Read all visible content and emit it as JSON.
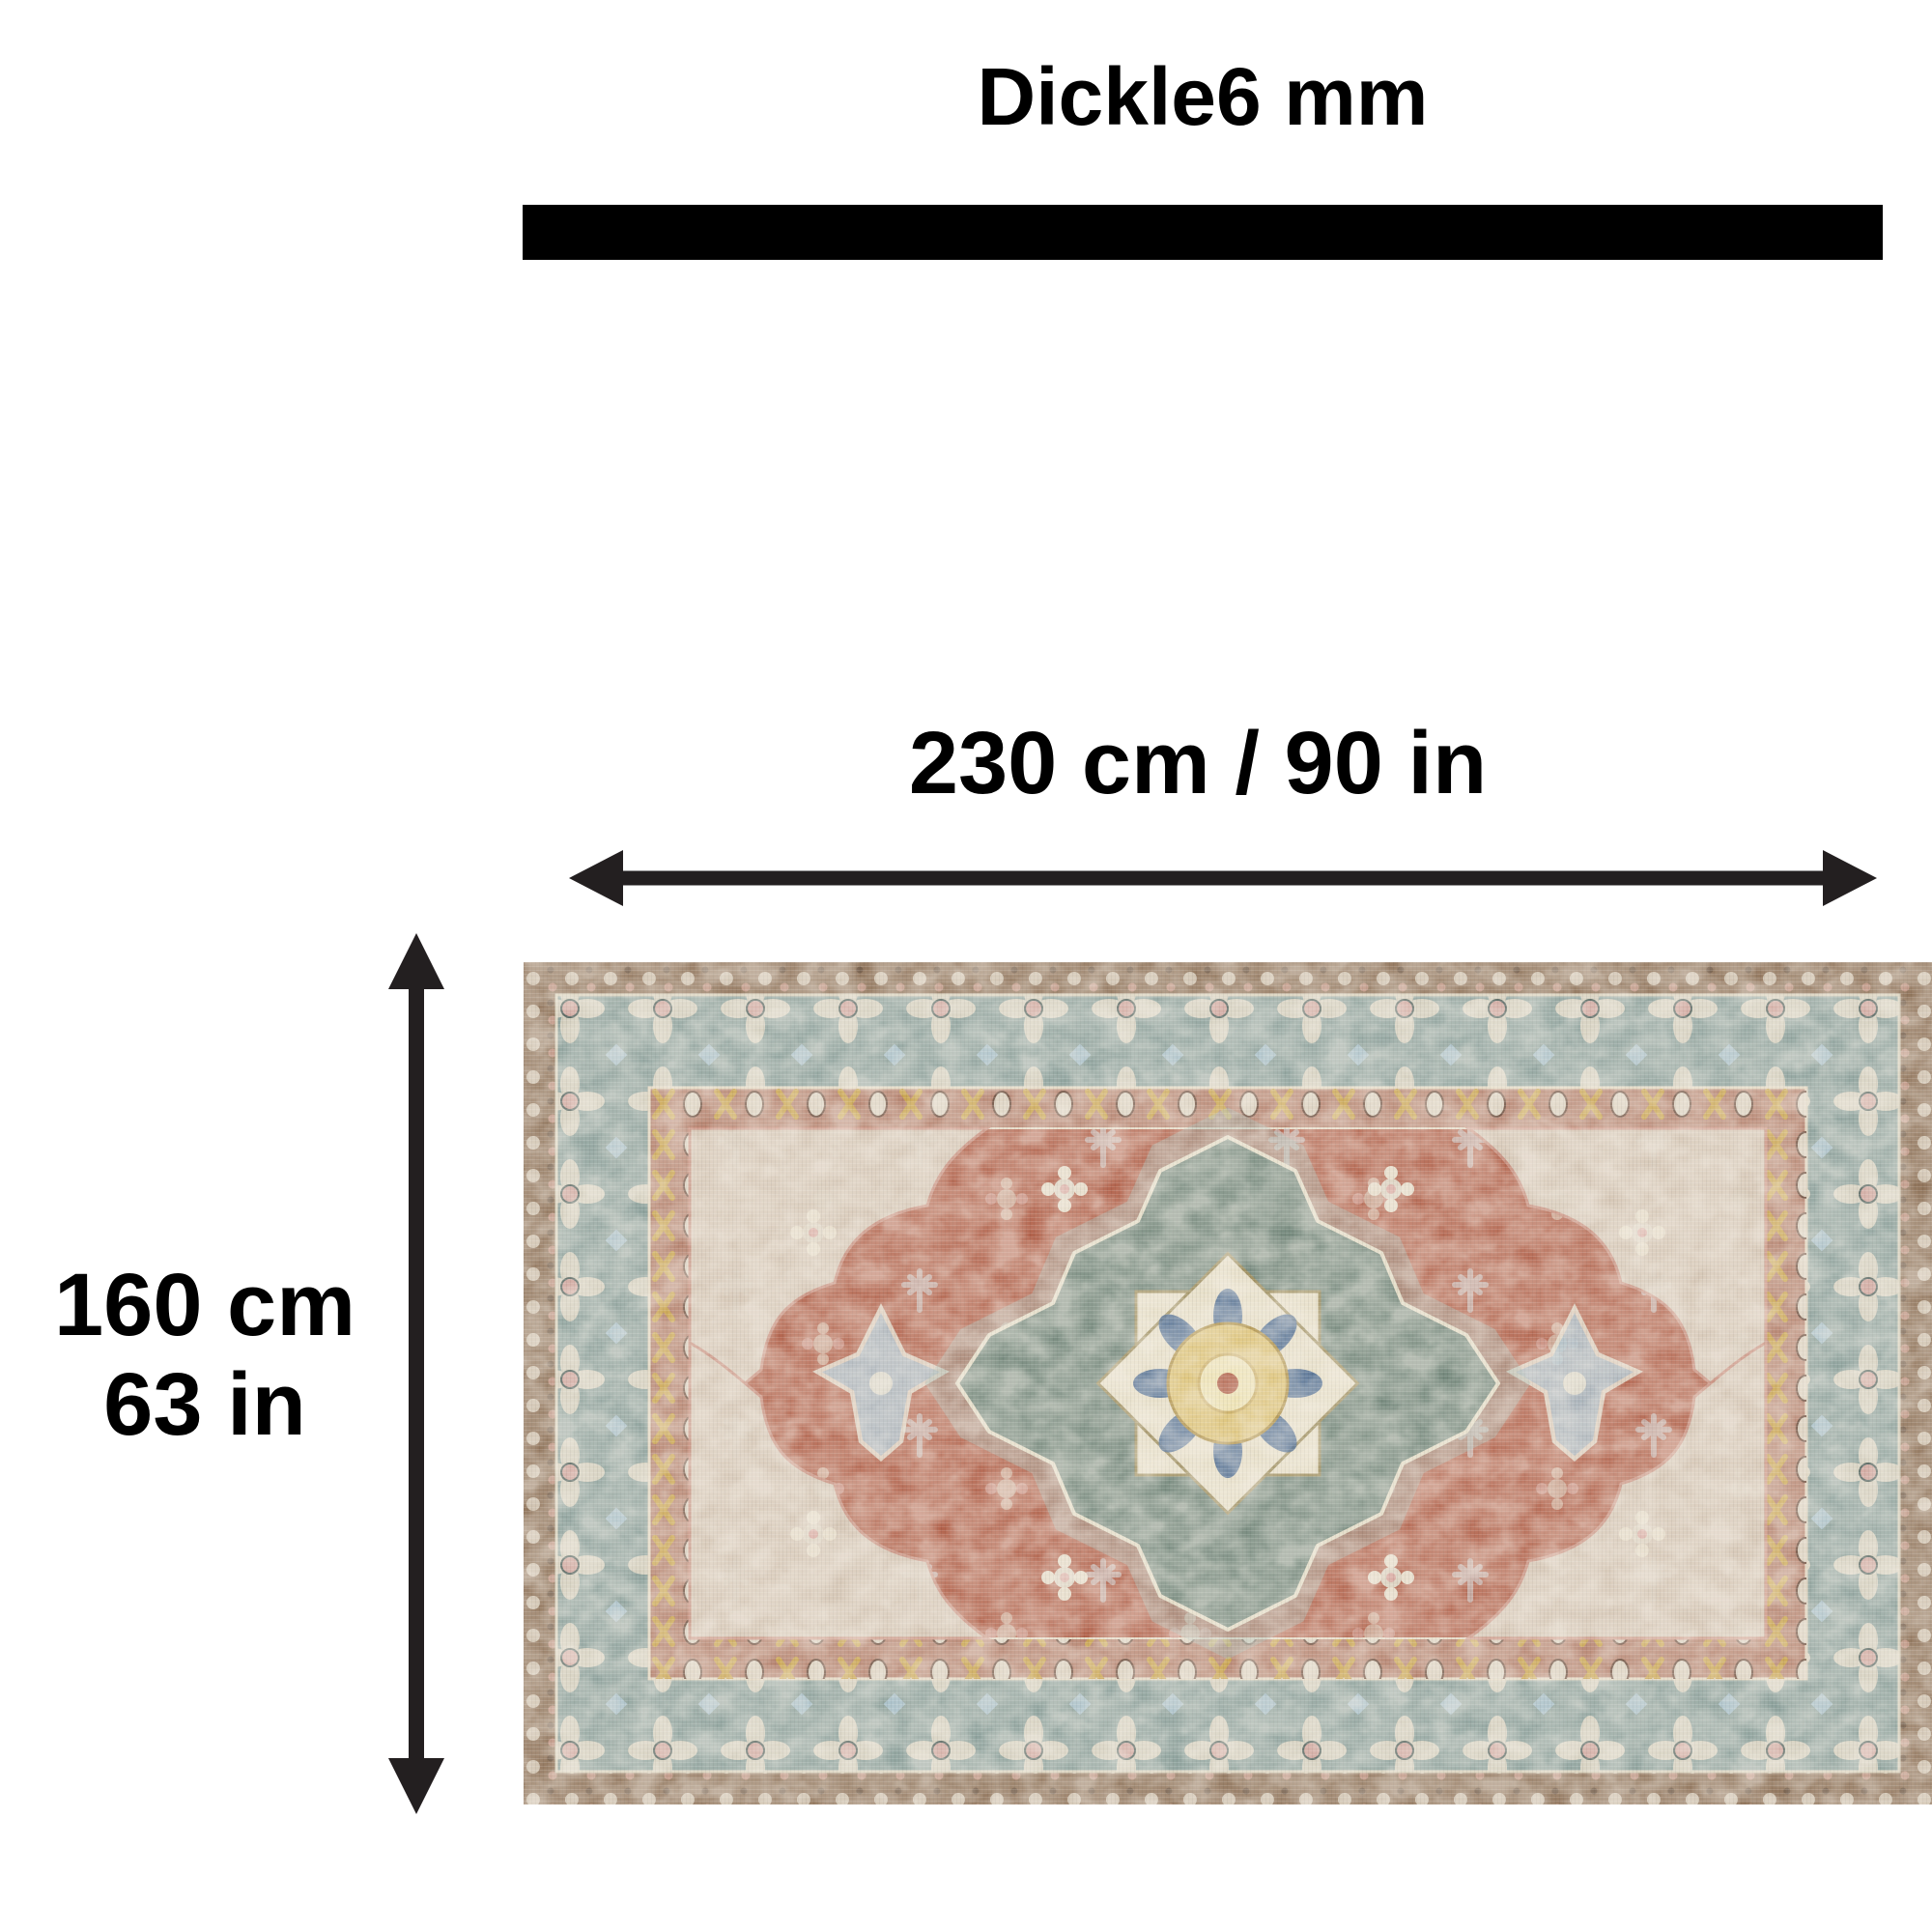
{
  "page": {
    "background": "#ffffff"
  },
  "diagram": {
    "title": "Dickle6 mm",
    "thickness_bar_color": "#000000",
    "width_label": "230 cm / 90 in",
    "height_label_line1": "160 cm",
    "height_label_line2": "63 in",
    "arrow_color": "#231f20",
    "rug_image": {
      "name": "vintage-oriental-rug-photo",
      "palette": {
        "outer_border": "#8d7056",
        "main_border": "#8ca19c",
        "guard_stripe": "#b5816d",
        "field": "#b2614a",
        "spandrel": "#d8cdbc",
        "medallion": "#75897d",
        "medallion_halo": "#9db3ab",
        "medallion_star": "#e7dfc8",
        "medallion_center": "#dcc172",
        "accent_blue": "#a9c2cf",
        "accent_pink": "#d9a8a0",
        "accent_navy": "#40628e",
        "accent_gold": "#c9a24a",
        "accent_cream": "#ddd3c2"
      }
    }
  }
}
